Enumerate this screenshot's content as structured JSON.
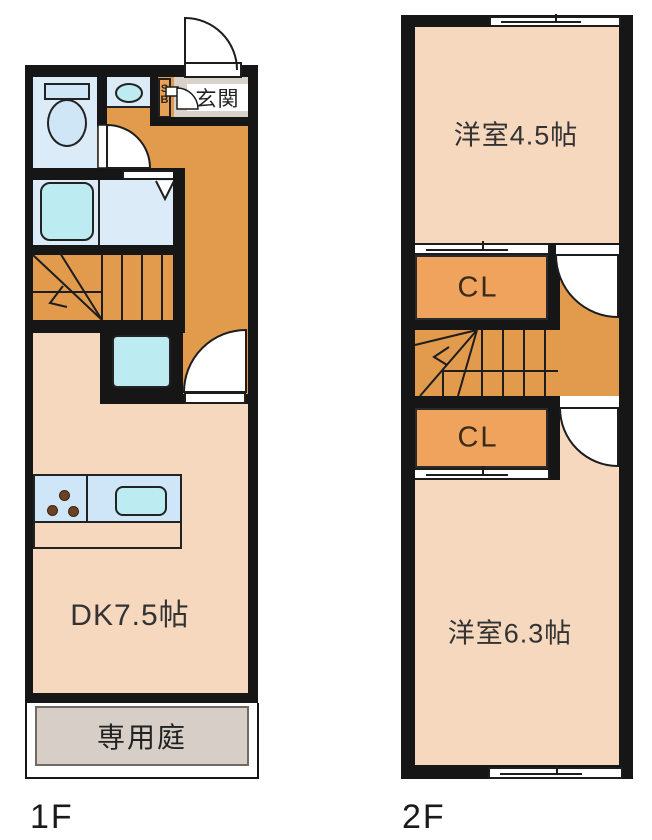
{
  "palette": {
    "wall": "#161616",
    "hallway_orange": "#e29a4d",
    "closet_orange": "#f0a35c",
    "room_pink": "#f6d8bf",
    "wet_area_blue": "#dcebf8",
    "fixture_cyan": "#bdebf2",
    "entrance_gray": "#d8d2cb",
    "garden_gray": "#d7cfc7"
  },
  "floor1": {
    "label": "1F",
    "entrance": "玄関",
    "shoe_box": "SB",
    "dining_kitchen": "DK7.5帖",
    "private_garden": "専用庭"
  },
  "floor2": {
    "label": "2F",
    "room_small": "洋室4.5帖",
    "closet_upper": "CL",
    "closet_lower": "CL",
    "room_large": "洋室6.3帖"
  }
}
